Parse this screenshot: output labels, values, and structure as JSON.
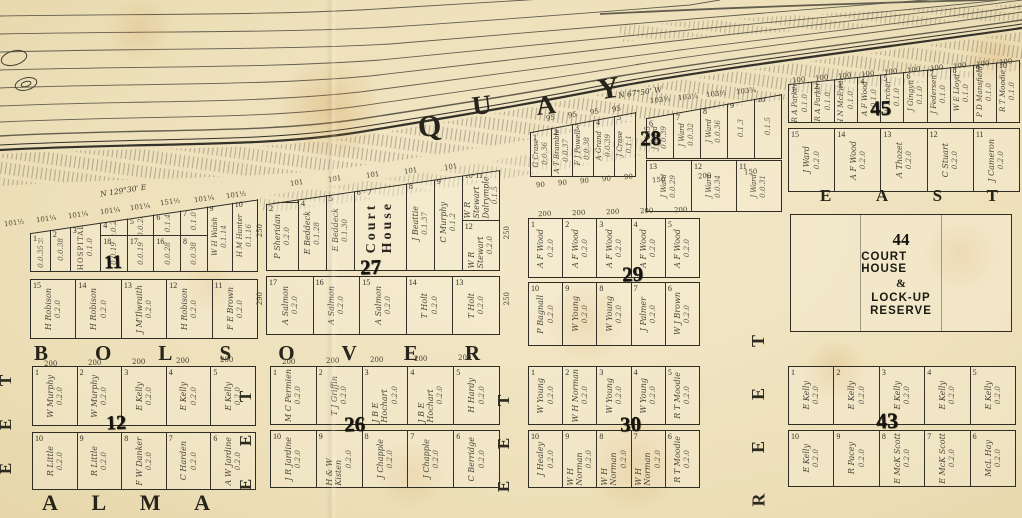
{
  "paper_color": "#eee1bd",
  "ink_color": "#2e2c23",
  "streets": {
    "quay_letters": [
      "Q",
      "U",
      "A",
      "Y"
    ],
    "bolsover_letters": [
      "B",
      "O",
      "L",
      "S",
      "O",
      "V",
      "E",
      "R"
    ],
    "alma_letters": [
      "A",
      "L",
      "M",
      "A"
    ],
    "east_letters": [
      "E",
      "A",
      "S",
      "T"
    ],
    "vertical_1": [
      "T",
      "E",
      "E"
    ],
    "vertical_2": [
      "T",
      "E",
      "E"
    ],
    "vertical_3": [
      "T",
      "E",
      "E"
    ],
    "vertical_4": [
      "T",
      "E",
      "E",
      "R"
    ]
  },
  "bearings": {
    "left": "N 129°30' E",
    "right": "N 67°50' W"
  },
  "reserve": {
    "number": "44",
    "line1": "COURT HOUSE",
    "line2": "&",
    "line3": "LOCK-UP",
    "line4": "RESERVE"
  },
  "blocks": {
    "b11": {
      "number": "11",
      "top": [
        {
          "n": "1",
          "owner": "",
          "area": "0.0.35½",
          "w": 0.7
        },
        {
          "n": "2",
          "owner": "",
          "area": "0.0.38",
          "w": 0.7
        },
        {
          "n": "3",
          "owner": "HOSPITAL",
          "area": "0.1.0",
          "cls": "hosp",
          "w": 1.1
        },
        {
          "w": 0.95,
          "stack": [
            {
              "n": "4",
              "owner": "",
              "area": "0.0.24"
            },
            {
              "n": "18",
              "owner": "",
              "area": "0.0.19"
            }
          ]
        },
        {
          "w": 0.95,
          "stack": [
            {
              "n": "5",
              "owner": "",
              "area": "0.0.26"
            },
            {
              "n": "17",
              "owner": "",
              "area": "0.0.19"
            }
          ]
        },
        {
          "w": 0.95,
          "stack": [
            {
              "n": "6",
              "owner": "",
              "area": "0.1.4"
            },
            {
              "n": "16",
              "owner": "",
              "area": "0.0.28"
            }
          ]
        },
        {
          "w": 0.95,
          "stack": [
            {
              "n": "7",
              "owner": "",
              "area": "0.1.0"
            },
            {
              "n": "8",
              "owner": "",
              "area": "0.0.38"
            }
          ]
        },
        {
          "n": "9",
          "owner": "W H Walsh",
          "area": "0.1.14",
          "w": 0.9
        },
        {
          "n": "10",
          "owner": "H M Hunter",
          "area": "0.1.16",
          "w": 0.9
        }
      ],
      "bottom": [
        {
          "n": "15",
          "owner": "H Robison",
          "area": "0.2.0"
        },
        {
          "n": "14",
          "owner": "H Robison",
          "area": "0.2.0"
        },
        {
          "n": "13",
          "owner": "J M'Ilwraith",
          "area": "0.2.0"
        },
        {
          "n": "12",
          "owner": "H Robison",
          "area": "0.2.0"
        },
        {
          "n": "11",
          "owner": "F E Brown",
          "area": "0.2.0"
        }
      ]
    },
    "b27": {
      "number": "27",
      "top": [
        {
          "w": 1.15,
          "cls": "s30",
          "stack": [
            {
              "n": "1·3",
              "owner": "J Griffin · J Ryan",
              "area": "0.0.29"
            },
            {
              "n": "2",
              "owner": "P Sheridan",
              "area": "0.2.0"
            }
          ]
        },
        {
          "n": "4",
          "owner": "E Beddeck",
          "area": "0.1.28"
        },
        {
          "n": "5",
          "owner": "E Beddeck",
          "area": "0.1.30"
        },
        {
          "n": "6 · 7",
          "owner": "Court\nHouse",
          "area": "",
          "cls": "courthouse",
          "w": 1.9
        },
        {
          "n": "8",
          "owner": "J Beattie",
          "area": "0.1.37"
        },
        {
          "n": "9",
          "owner": "C Murphy",
          "area": "0.1.2"
        },
        {
          "w": 1.35,
          "stack": [
            {
              "n": "10·11",
              "owner": "W R Stewart\nDalrymple",
              "area": "0.1.5"
            },
            {
              "n": "12",
              "owner": "W R Stewart",
              "area": "0.2.0"
            }
          ]
        }
      ],
      "bottom": [
        {
          "n": "17",
          "owner": "A Salmon",
          "area": "0.2.0"
        },
        {
          "n": "16",
          "owner": "A Salmon",
          "area": "0.2.0"
        },
        {
          "n": "15",
          "owner": "A Salmon",
          "area": "0.2.0"
        },
        {
          "n": "14",
          "owner": "T Holt",
          "area": "0.2.0"
        },
        {
          "n": "13",
          "owner": "T Holt",
          "area": "0.2.0"
        }
      ]
    },
    "b28L": {
      "number": "",
      "top": [
        {
          "n": "1",
          "owner": "G Crase",
          "area": "0.0.36"
        },
        {
          "n": "2",
          "owner": "A T Bramble",
          "area": "0.0.37"
        },
        {
          "n": "3",
          "owner": "F J Powell",
          "area": "0.0.38"
        },
        {
          "n": "4",
          "owner": "A Grand",
          "area": "0.0.39"
        },
        {
          "n": "5",
          "owner": "J Crase",
          "area": "0.1.1"
        }
      ]
    },
    "b28R": {
      "number": "28",
      "top": [
        {
          "n": "6",
          "owner": "J Ward",
          "area": "0.0.39"
        },
        {
          "n": "7",
          "owner": "J Ward",
          "area": "0.0.32"
        },
        {
          "n": "8",
          "owner": "J Ward",
          "area": "0.0.36"
        },
        {
          "n": "9",
          "owner": "",
          "area": "0.1.3"
        },
        {
          "n": "10",
          "owner": "",
          "area": "0.1.5"
        }
      ],
      "bottom": [
        {
          "n": "13",
          "owner": "J Ward",
          "area": "0.0.29"
        },
        {
          "n": "12",
          "owner": "J Ward",
          "area": "0.0.34"
        },
        {
          "n": "11",
          "owner": "J Ward",
          "area": "0.0.31"
        }
      ]
    },
    "b29": {
      "number": "29",
      "top": [
        {
          "n": "1",
          "owner": "A F Wood",
          "area": "0.2.0"
        },
        {
          "n": "2",
          "owner": "A F Wood",
          "area": "0.2.0"
        },
        {
          "n": "3",
          "owner": "A F Wood",
          "area": "0.2.0"
        },
        {
          "n": "4",
          "owner": "A F Wood",
          "area": "0.2.0"
        },
        {
          "n": "5",
          "owner": "A F Wood",
          "area": "0.2.0"
        }
      ],
      "bottom": [
        {
          "n": "10",
          "owner": "P Bagnall",
          "area": "0.2.0"
        },
        {
          "n": "9",
          "owner": "W Young",
          "area": "0.2.0"
        },
        {
          "n": "8",
          "owner": "W Young",
          "area": "0.2.0"
        },
        {
          "n": "7",
          "owner": "J Palmer",
          "area": "0.2.0"
        },
        {
          "n": "6",
          "owner": "W J Brown",
          "area": "0.2.0"
        }
      ]
    },
    "b30": {
      "number": "30",
      "top": [
        {
          "n": "1",
          "owner": "W Young",
          "area": "0.2.0"
        },
        {
          "n": "2",
          "owner": "W H Norman",
          "area": "0.2.0"
        },
        {
          "n": "3",
          "owner": "W Young",
          "area": "0.2.0"
        },
        {
          "n": "4",
          "owner": "W Young",
          "area": "0.2.0"
        },
        {
          "n": "5",
          "owner": "R T Moodie",
          "area": "0.2.0"
        }
      ],
      "bottom": [
        {
          "n": "10",
          "owner": "J Healey",
          "area": "0.2.0"
        },
        {
          "n": "9",
          "owner": "W H Norman",
          "area": "0.2.0"
        },
        {
          "n": "8",
          "owner": "W H Norman",
          "area": "0.2.0"
        },
        {
          "n": "7",
          "owner": "W H Norman",
          "area": "0.2.0"
        },
        {
          "n": "6",
          "owner": "R T Moodie",
          "area": "0.2.0"
        }
      ]
    },
    "b26": {
      "number": "26",
      "top": [
        {
          "n": "1",
          "owner": "M C Permien",
          "area": "0.2.0"
        },
        {
          "n": "2",
          "owner": "T J Griffin",
          "area": "0.2.0"
        },
        {
          "n": "3",
          "owner": "J B E Hochart",
          "area": "0.2.0"
        },
        {
          "n": "4",
          "owner": "J B E Hochart",
          "area": "0.2.0"
        },
        {
          "n": "5",
          "owner": "H Hardy",
          "area": "0.2.0"
        }
      ],
      "bottom": [
        {
          "n": "10",
          "owner": "J R Jardine",
          "area": "0.2.0"
        },
        {
          "n": "9",
          "owner": "H & W Kisten",
          "area": "0.2.0"
        },
        {
          "n": "8",
          "owner": "J Chapple",
          "area": "0.2.0"
        },
        {
          "n": "7",
          "owner": "J Chapple",
          "area": "0.2.0"
        },
        {
          "n": "6",
          "owner": "C Berridge",
          "area": "0.2.0"
        }
      ]
    },
    "b12": {
      "number": "12",
      "top": [
        {
          "n": "1",
          "owner": "W Murphy",
          "area": "0.2.0"
        },
        {
          "n": "2",
          "owner": "W Murphy",
          "area": "0.2.0"
        },
        {
          "n": "3",
          "owner": "E Kelly",
          "area": "0.2.0"
        },
        {
          "n": "4",
          "owner": "E Kelly",
          "area": "0.2.0"
        },
        {
          "n": "5",
          "owner": "E Kelly",
          "area": "0.2.0"
        }
      ],
      "bottom": [
        {
          "n": "10",
          "owner": "R Little",
          "area": "0.2.0"
        },
        {
          "n": "9",
          "owner": "R Little",
          "area": "0.2.0"
        },
        {
          "n": "8",
          "owner": "F W Danker",
          "area": "0.2.0"
        },
        {
          "n": "7",
          "owner": "C Harden",
          "area": "0.2.0"
        },
        {
          "n": "6",
          "owner": "A W Jardine",
          "area": "0.2.0"
        }
      ]
    },
    "b43": {
      "number": "43",
      "top": [
        {
          "n": "1",
          "owner": "E Kelly",
          "area": "0.2.0"
        },
        {
          "n": "2",
          "owner": "E Kelly",
          "area": "0.2.0"
        },
        {
          "n": "3",
          "owner": "E Kelly",
          "area": "0.2.0"
        },
        {
          "n": "4",
          "owner": "E Kelly",
          "area": "0.2.0"
        },
        {
          "n": "5",
          "owner": "E Kelly",
          "area": "0.2.0"
        }
      ],
      "bottom": [
        {
          "n": "10",
          "owner": "E Kelly",
          "area": "0.2.0"
        },
        {
          "n": "9",
          "owner": "R Pacey",
          "area": "0.2.0"
        },
        {
          "n": "8",
          "owner": "E McK Scott",
          "area": "0.2.0"
        },
        {
          "n": "7",
          "owner": "E McK Scott",
          "area": "0.2.0"
        },
        {
          "n": "6",
          "owner": "McL Hay",
          "area": "0.2.0"
        }
      ]
    },
    "b45": {
      "number": "45",
      "top": [
        {
          "n": "1",
          "owner": "R A Parker",
          "area": "0.1.0"
        },
        {
          "n": "2",
          "owner": "R A Parker",
          "area": "0.1.0"
        },
        {
          "n": "3",
          "owner": "H N McEwan",
          "area": "0.1.0"
        },
        {
          "n": "4",
          "owner": "A F Wood",
          "area": "0.1.0"
        },
        {
          "n": "5",
          "owner": "W Archer",
          "area": "0.1.0"
        },
        {
          "n": "6",
          "owner": "J Gingyn",
          "area": "0.1.0"
        },
        {
          "n": "7",
          "owner": "J Federsen",
          "area": "0.1.0"
        },
        {
          "n": "8",
          "owner": "W E Lloyd",
          "area": "0.1.0"
        },
        {
          "n": "9",
          "owner": "P D Mansfield",
          "area": "0.1.0"
        },
        {
          "n": "10",
          "owner": "R T Moodie",
          "area": "0.1.0"
        }
      ],
      "bottom": [
        {
          "n": "15",
          "owner": "J Ward",
          "area": "0.2.0"
        },
        {
          "n": "14",
          "owner": "A F Wood",
          "area": "0.2.0"
        },
        {
          "n": "13",
          "owner": "A Thozet",
          "area": "0.2.0"
        },
        {
          "n": "12",
          "owner": "C Stuart",
          "area": "0.2.0"
        },
        {
          "n": "11",
          "owner": "J Cameron",
          "area": "0.2.0"
        }
      ]
    }
  },
  "dims": [
    {
      "t": "101½",
      "x": 4,
      "y": 219,
      "r": -8
    },
    {
      "t": "101¼",
      "x": 36,
      "y": 215,
      "r": -8
    },
    {
      "t": "101¼",
      "x": 68,
      "y": 211,
      "r": -8
    },
    {
      "t": "101¼",
      "x": 100,
      "y": 207,
      "r": -8
    },
    {
      "t": "101¼",
      "x": 130,
      "y": 203,
      "r": -8
    },
    {
      "t": "151½",
      "x": 160,
      "y": 198,
      "r": -8
    },
    {
      "t": "101¼",
      "x": 194,
      "y": 195,
      "r": -8
    },
    {
      "t": "101½",
      "x": 226,
      "y": 191,
      "r": -8
    },
    {
      "t": "101",
      "x": 290,
      "y": 179,
      "r": -8
    },
    {
      "t": "101",
      "x": 328,
      "y": 175,
      "r": -8
    },
    {
      "t": "101",
      "x": 366,
      "y": 171,
      "r": -8
    },
    {
      "t": "101",
      "x": 404,
      "y": 167,
      "r": -8
    },
    {
      "t": "101",
      "x": 444,
      "y": 163,
      "r": -8
    },
    {
      "t": "95",
      "x": 546,
      "y": 114,
      "r": -9
    },
    {
      "t": "95",
      "x": 568,
      "y": 111,
      "r": -9
    },
    {
      "t": "95",
      "x": 590,
      "y": 108,
      "r": -9
    },
    {
      "t": "95",
      "x": 612,
      "y": 105,
      "r": -9
    },
    {
      "t": "103½",
      "x": 650,
      "y": 96,
      "r": -6
    },
    {
      "t": "103¼",
      "x": 678,
      "y": 93,
      "r": -6
    },
    {
      "t": "103½",
      "x": 706,
      "y": 90,
      "r": -6
    },
    {
      "t": "103¾",
      "x": 736,
      "y": 87,
      "r": -6
    },
    {
      "t": "90",
      "x": 536,
      "y": 181,
      "r": -4
    },
    {
      "t": "90",
      "x": 558,
      "y": 179,
      "r": -4
    },
    {
      "t": "90",
      "x": 580,
      "y": 177,
      "r": -4
    },
    {
      "t": "90",
      "x": 602,
      "y": 175,
      "r": -4
    },
    {
      "t": "90",
      "x": 624,
      "y": 173,
      "r": -4
    },
    {
      "t": "150",
      "x": 652,
      "y": 176,
      "r": -4
    },
    {
      "t": "200",
      "x": 698,
      "y": 172,
      "r": -4
    },
    {
      "t": "150",
      "x": 744,
      "y": 168,
      "r": -4
    },
    {
      "t": "165",
      "x": 644,
      "y": 126,
      "v": 1
    },
    {
      "t": "100",
      "x": 792,
      "y": 76,
      "r": -5
    },
    {
      "t": "100",
      "x": 815,
      "y": 74,
      "r": -5
    },
    {
      "t": "100",
      "x": 838,
      "y": 72,
      "r": -5
    },
    {
      "t": "100",
      "x": 861,
      "y": 70,
      "r": -5
    },
    {
      "t": "100",
      "x": 884,
      "y": 68,
      "r": -5
    },
    {
      "t": "100",
      "x": 907,
      "y": 66,
      "r": -5
    },
    {
      "t": "100",
      "x": 930,
      "y": 64,
      "r": -5
    },
    {
      "t": "100",
      "x": 953,
      "y": 62,
      "r": -5
    },
    {
      "t": "100",
      "x": 976,
      "y": 60,
      "r": -5
    },
    {
      "t": "100",
      "x": 999,
      "y": 58,
      "r": -5
    },
    {
      "t": "200",
      "x": 538,
      "y": 210,
      "r": -2
    },
    {
      "t": "200",
      "x": 572,
      "y": 209,
      "r": -2
    },
    {
      "t": "200",
      "x": 606,
      "y": 208,
      "r": -2
    },
    {
      "t": "200",
      "x": 640,
      "y": 207,
      "r": -2
    },
    {
      "t": "200",
      "x": 674,
      "y": 206,
      "r": -2
    },
    {
      "t": "200",
      "x": 44,
      "y": 360,
      "r": 0
    },
    {
      "t": "200",
      "x": 88,
      "y": 359,
      "r": 0
    },
    {
      "t": "200",
      "x": 132,
      "y": 358,
      "r": 0
    },
    {
      "t": "200",
      "x": 176,
      "y": 357,
      "r": 0
    },
    {
      "t": "200",
      "x": 220,
      "y": 356,
      "r": 0
    },
    {
      "t": "200",
      "x": 282,
      "y": 358,
      "r": 0
    },
    {
      "t": "200",
      "x": 326,
      "y": 357,
      "r": 0
    },
    {
      "t": "200",
      "x": 370,
      "y": 356,
      "r": 0
    },
    {
      "t": "200",
      "x": 414,
      "y": 355,
      "r": 0
    },
    {
      "t": "200",
      "x": 458,
      "y": 354,
      "r": 0
    },
    {
      "t": "250",
      "x": 256,
      "y": 224,
      "v": 1
    },
    {
      "t": "290",
      "x": 256,
      "y": 292,
      "v": 1
    },
    {
      "t": "250",
      "x": 503,
      "y": 226,
      "v": 1
    },
    {
      "t": "250",
      "x": 503,
      "y": 292,
      "v": 1
    }
  ]
}
